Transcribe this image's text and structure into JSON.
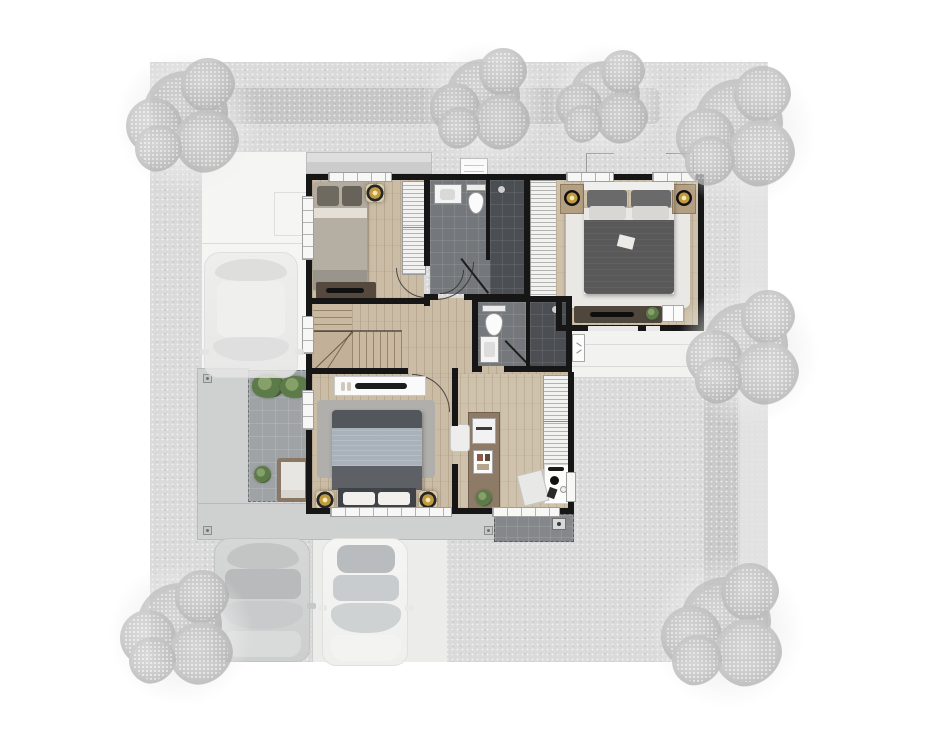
{
  "page": {
    "kind": "architectural-floor-plan-render",
    "floor": "upper-floor",
    "background": "#ffffff"
  },
  "palette": {
    "plot": "#dadada",
    "hedge": "#c6c6c6",
    "driveway": "#f5f5f4",
    "parking_lane": "#ececeb",
    "roof_slab": "#cfd1d1",
    "terrace_tile": "#9fa3a6",
    "balcony_tile": "#84888b",
    "wall": "#161616",
    "wood_floor": "#cbbca6",
    "wood_floor_master": "#cfc2ac",
    "bath_tile": "#74777b",
    "shower_tile": "#4b4e52",
    "wardrobe": "#f2f2f0",
    "rug_light": "#e9e8e5",
    "rug_gray": "#b1afab",
    "bed_master": "#595959",
    "bed_blue": "#a9b2bb",
    "bed_tan": "#b3aba0",
    "console_white": "#fafafa",
    "dresser_wood": "#55493d",
    "desk_wood": "#8d7b67",
    "gold_accent": "#c09a41",
    "plant_green": "#5d7a49",
    "awning": "#f2f2f1",
    "car_gray": "#d2d3d3",
    "car_white": "#f4f4f3",
    "tree_gray": "#c3c3c3"
  },
  "rooms": [
    {
      "id": "bedroom-2",
      "contents": "single bed, wardrobe, dresser, ceiling spot"
    },
    {
      "id": "bathroom-1",
      "contents": "vanity, toilet, walk-in shower"
    },
    {
      "id": "walk-in-closet",
      "contents": "built-in wardrobe"
    },
    {
      "id": "master-bedroom",
      "contents": "double bed, nightstands with lamps, rug, dresser, plant"
    },
    {
      "id": "hallway-landing",
      "contents": "L-shaped staircase, door swings"
    },
    {
      "id": "bathroom-2",
      "contents": "toilet, vanity, shower"
    },
    {
      "id": "bedroom-3",
      "contents": "double bed, TV console, rug, ceiling spots"
    },
    {
      "id": "study",
      "contents": "desk island, printer, wardrobe, office desk and chair, plant"
    },
    {
      "id": "terrace",
      "contents": "tiled deck, planter bushes, armchair, potted plant"
    },
    {
      "id": "service-balcony",
      "contents": "tiled strip with floor drain"
    }
  ],
  "exterior": {
    "driveway_side": "left",
    "roof_slab_shape": "L-shaped",
    "awning_side": "right",
    "hedges": [
      "top-row",
      "right-row"
    ],
    "tree_count": 7
  },
  "vehicles": [
    {
      "id": "car-carport-upper",
      "tone": "ghost-gray"
    },
    {
      "id": "car-parking-left",
      "tone": "gray"
    },
    {
      "id": "car-parking-right",
      "tone": "white"
    }
  ]
}
